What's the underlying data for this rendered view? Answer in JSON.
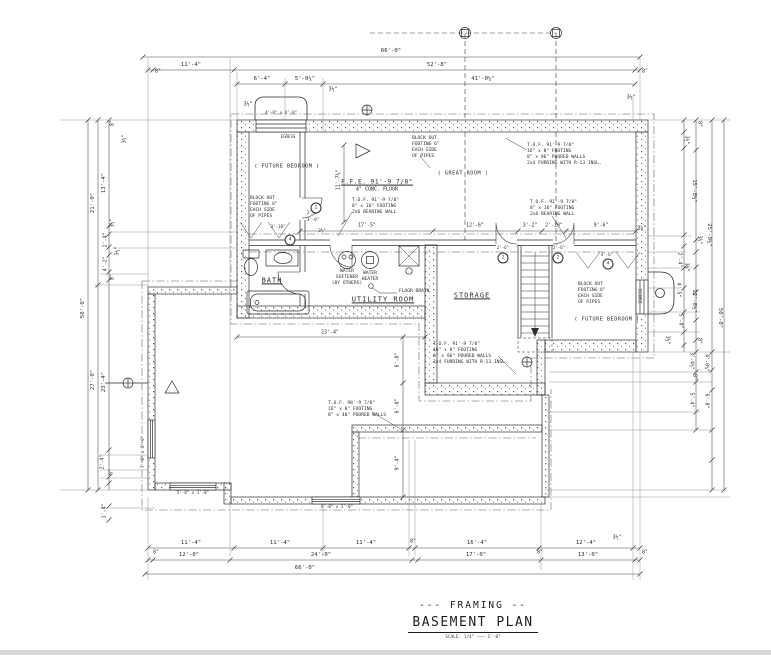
{
  "drawing": {
    "title_line1": "--- FRAMING --",
    "title_line2": "BASEMENT PLAN",
    "scale_note": "SCALE: 1/4\"  ———  1'-0\""
  },
  "labels": [
    {
      "t": "66'-0\"",
      "x": 391,
      "y": 52
    },
    {
      "t": "11'-4\"",
      "x": 191,
      "y": 66
    },
    {
      "t": "52'-8\"",
      "x": 437,
      "y": 66
    },
    {
      "t": "8\"",
      "x": 158,
      "y": 72,
      "c": "s"
    },
    {
      "t": "8\"",
      "x": 645,
      "y": 72,
      "c": "s"
    },
    {
      "t": "6'-4\"",
      "x": 262,
      "y": 80
    },
    {
      "t": "5'-0¼\"",
      "x": 305,
      "y": 80
    },
    {
      "t": "41'-0¼\"",
      "x": 483,
      "y": 80
    },
    {
      "t": "3½\"",
      "x": 333,
      "y": 90,
      "c": "s"
    },
    {
      "t": "3½\"",
      "x": 631,
      "y": 98,
      "c": "s"
    },
    {
      "t": "3½\"",
      "x": 248,
      "y": 105,
      "c": "s"
    },
    {
      "t": "11'-4\"",
      "x": 191,
      "y": 544
    },
    {
      "t": "11'-4\"",
      "x": 280,
      "y": 544
    },
    {
      "t": "11'-4\"",
      "x": 366,
      "y": 544
    },
    {
      "t": "8\"",
      "x": 413,
      "y": 542,
      "c": "s"
    },
    {
      "t": "16'-4\"",
      "x": 477,
      "y": 544
    },
    {
      "t": "12'-4\"",
      "x": 586,
      "y": 544
    },
    {
      "t": "3½\"",
      "x": 617,
      "y": 538,
      "c": "s"
    },
    {
      "t": "8\"",
      "x": 156,
      "y": 553,
      "c": "s"
    },
    {
      "t": "8\"",
      "x": 645,
      "y": 553,
      "c": "s"
    },
    {
      "t": "8\"",
      "x": 540,
      "y": 553,
      "c": "s"
    },
    {
      "t": "12'-0\"",
      "x": 189,
      "y": 556
    },
    {
      "t": "24'-0\"",
      "x": 321,
      "y": 556
    },
    {
      "t": "17'-0\"",
      "x": 476,
      "y": 556
    },
    {
      "t": "13'-0\"",
      "x": 588,
      "y": 556
    },
    {
      "t": "66'-0\"",
      "x": 305,
      "y": 569
    },
    {
      "t": "50'-0\"",
      "x": 84,
      "y": 308,
      "r": -90
    },
    {
      "t": "21'-0\"",
      "x": 94,
      "y": 203,
      "r": -90
    },
    {
      "t": "27'-0\"",
      "x": 94,
      "y": 380,
      "r": -90
    },
    {
      "t": "13'-4\"",
      "x": 105,
      "y": 183,
      "r": -90
    },
    {
      "t": "23'-4\"",
      "x": 105,
      "y": 382,
      "r": -90
    },
    {
      "t": "8\"",
      "x": 113,
      "y": 123,
      "r": -90,
      "c": "s"
    },
    {
      "t": "3½\"",
      "x": 125,
      "y": 139,
      "r": -90,
      "c": "s"
    },
    {
      "t": "3½\"",
      "x": 113,
      "y": 223,
      "r": -90,
      "c": "s"
    },
    {
      "t": "2'-4\"",
      "x": 106,
      "y": 240,
      "r": -90,
      "c": "s"
    },
    {
      "t": "3½\"",
      "x": 118,
      "y": 251,
      "r": -90,
      "c": "s"
    },
    {
      "t": "4'-2\"",
      "x": 106,
      "y": 264,
      "r": -90,
      "c": "s"
    },
    {
      "t": "8\"",
      "x": 113,
      "y": 277,
      "r": -90,
      "c": "s"
    },
    {
      "t": "2'-4\"",
      "x": 103,
      "y": 462,
      "r": -90,
      "c": "s"
    },
    {
      "t": "8\"",
      "x": 112,
      "y": 472,
      "r": -90,
      "c": "s"
    },
    {
      "t": "1'-4\"",
      "x": 105,
      "y": 511,
      "r": -90,
      "c": "s"
    },
    {
      "t": "50'-0\"",
      "x": 719,
      "y": 318,
      "r": 90
    },
    {
      "t": "25'-0½\"",
      "x": 708,
      "y": 235,
      "r": 90
    },
    {
      "t": "15'-8½\"",
      "x": 693,
      "y": 191,
      "r": 90
    },
    {
      "t": "12'-8½\"",
      "x": 693,
      "y": 301,
      "r": 90
    },
    {
      "t": "8\"",
      "x": 699,
      "y": 124,
      "r": 90,
      "c": "s"
    },
    {
      "t": "3½\"",
      "x": 686,
      "y": 140,
      "r": 90,
      "c": "s"
    },
    {
      "t": "3½\"",
      "x": 699,
      "y": 240,
      "r": 90,
      "c": "s"
    },
    {
      "t": "2'-4\"",
      "x": 679,
      "y": 260,
      "r": 90,
      "c": "s"
    },
    {
      "t": "3½\"",
      "x": 686,
      "y": 267,
      "r": 90,
      "c": "s"
    },
    {
      "t": "4'-5\"",
      "x": 678,
      "y": 290,
      "r": 90,
      "c": "s"
    },
    {
      "t": "5'-0\"",
      "x": 680,
      "y": 321,
      "r": 90,
      "c": "s"
    },
    {
      "t": "3½\"",
      "x": 667,
      "y": 340,
      "r": 90,
      "c": "s"
    },
    {
      "t": "8\"",
      "x": 699,
      "y": 341,
      "r": 90,
      "c": "s"
    },
    {
      "t": "3'-4½\"",
      "x": 691,
      "y": 361,
      "r": 90,
      "c": "s"
    },
    {
      "t": "4'-0¼\"",
      "x": 706,
      "y": 363,
      "r": 90,
      "c": "s"
    },
    {
      "t": "8\"",
      "x": 694,
      "y": 377,
      "r": 90,
      "c": "s"
    },
    {
      "t": "5'-4\"",
      "x": 691,
      "y": 400,
      "r": 90,
      "c": "s"
    },
    {
      "t": "6'-0\"",
      "x": 706,
      "y": 401,
      "r": 90,
      "c": "s"
    },
    {
      "t": "17'-5\"",
      "x": 367,
      "y": 226,
      "c": "s"
    },
    {
      "t": "12'-6\"",
      "x": 475,
      "y": 226,
      "c": "s"
    },
    {
      "t": "3'-2\"",
      "x": 530,
      "y": 226,
      "c": "s"
    },
    {
      "t": "2'-10\"",
      "x": 554,
      "y": 226,
      "c": "s"
    },
    {
      "t": "9'-6\"",
      "x": 601,
      "y": 226,
      "c": "s"
    },
    {
      "t": "3½\"",
      "x": 642,
      "y": 229,
      "c": "s"
    },
    {
      "t": "11'-7¾\"",
      "x": 339,
      "y": 180,
      "r": -90,
      "c": "s"
    },
    {
      "t": "23'-4\"",
      "x": 330,
      "y": 333,
      "c": "s"
    },
    {
      "t": "6'-0\"",
      "x": 398,
      "y": 360,
      "r": -90,
      "c": "s"
    },
    {
      "t": "6'-0\"",
      "x": 398,
      "y": 406,
      "r": -90,
      "c": "s"
    },
    {
      "t": "9'-4\"",
      "x": 398,
      "y": 463,
      "r": -90,
      "c": "s"
    },
    {
      "t": "3'-10\"",
      "x": 278,
      "y": 227,
      "c": "xs"
    },
    {
      "t": "2'-6\"",
      "x": 313,
      "y": 213,
      "c": "xs"
    },
    {
      "t": "3'-0\"",
      "x": 313,
      "y": 220,
      "c": "xs"
    },
    {
      "t": "3½\"",
      "x": 322,
      "y": 231,
      "c": "xs"
    },
    {
      "t": "2'-6\"",
      "x": 503,
      "y": 248,
      "c": "xs"
    },
    {
      "t": "2'-6\"",
      "x": 559,
      "y": 248,
      "c": "xs"
    },
    {
      "t": "4'-6\"",
      "x": 607,
      "y": 255,
      "c": "xs"
    },
    {
      "t": "4'-0\" x 4'-0\"",
      "x": 281,
      "y": 113,
      "c": "xs"
    },
    {
      "t": "EGRESS",
      "x": 288,
      "y": 137,
      "c": "xs"
    },
    {
      "t": "EGRESS",
      "x": 641,
      "y": 296,
      "r": -90,
      "c": "xs"
    },
    {
      "t": "5'-0\" x 1'-0\"",
      "x": 193,
      "y": 493,
      "c": "xs"
    },
    {
      "t": "6'-0\" x 1'-0\"",
      "x": 337,
      "y": 507,
      "c": "xs"
    },
    {
      "t": "7'-6\" x 1'-0\"",
      "x": 143,
      "y": 452,
      "r": -90,
      "c": "xs"
    }
  ],
  "notes": [
    {
      "n": "room-future-bedroom-1",
      "c": "room-p ctr",
      "x": 287,
      "y": 167,
      "lines": [
        "( FUTURE BEDROOM )"
      ]
    },
    {
      "n": "room-great-room",
      "c": "room-p ctr",
      "x": 463,
      "y": 174,
      "lines": [
        "( GREAT ROOM )"
      ]
    },
    {
      "n": "room-future-bedroom-2",
      "c": "room-p ctr",
      "x": 607,
      "y": 320,
      "lines": [
        "( FUTURE BEDROOM )"
      ]
    },
    {
      "n": "room-bath",
      "c": "room ctr u",
      "x": 272,
      "y": 281,
      "lines": [
        "BATH"
      ]
    },
    {
      "n": "room-utility",
      "c": "room ctr u",
      "x": 383,
      "y": 300,
      "lines": [
        "UTILITY ROOM"
      ]
    },
    {
      "n": "room-storage",
      "c": "room ctr u",
      "x": 472,
      "y": 296,
      "lines": [
        "STORAGE"
      ]
    },
    {
      "n": "note-ffe",
      "c": "ffe ctr",
      "x": 377,
      "y": 186,
      "lines": [
        "F.F.E. 91'-9 7/8\"",
        "4\" CONC. FLOOR"
      ]
    },
    {
      "n": "note-tof-poured-1",
      "x": 527,
      "y": 143,
      "lines": [
        "T.O.F. 91'-9 7/8\"",
        "16\" x 8\" FOOTING",
        "8\" x 96\" POURED WALLS",
        "2x4 FURRING WITH R-13 INSL."
      ]
    },
    {
      "n": "note-tof-bearing-1",
      "x": 352,
      "y": 198,
      "lines": [
        "T.O.F. 91'-9 7/8\"",
        "8\" x 16\" FOOTING",
        "2x6 BEARING WALL"
      ]
    },
    {
      "n": "note-tof-bearing-2",
      "x": 530,
      "y": 200,
      "lines": [
        "T.O.F. 91'-9 7/8\"",
        "8\" x 16\" FOOTING",
        "2x6 BEARING WALL"
      ]
    },
    {
      "n": "note-tof-poured-2",
      "x": 433,
      "y": 342,
      "lines": [
        "T.O.F. 91'-9 7/8\"",
        "16\" x 8\" FOOTING",
        "8\" x 96\" POURED WALLS",
        "2x4 FURRING WITH R-13 INSL."
      ]
    },
    {
      "n": "note-tof-frost",
      "x": 328,
      "y": 401,
      "lines": [
        "T.O.F. 98'-9 7/8\"",
        "16\" x 8\" FOOTING",
        "8\" x 48\" POURED WALLS"
      ]
    },
    {
      "n": "note-blockout-1",
      "x": 412,
      "y": 136,
      "lines": [
        "BLOCK OUT",
        "FOOTING 6\"",
        "EACH SIDE",
        "OF PIPES"
      ]
    },
    {
      "n": "note-blockout-2",
      "x": 250,
      "y": 196,
      "lines": [
        "BLOCK OUT",
        "FOOTING 6\"",
        "EACH SIDE",
        "OF PIPES"
      ]
    },
    {
      "n": "note-blockout-3",
      "x": 578,
      "y": 282,
      "lines": [
        "BLOCK OUT",
        "FOOTING 6\"",
        "EACH SIDE",
        "OF PIPES"
      ]
    },
    {
      "n": "label-water-softener",
      "c": "ctr",
      "x": 347,
      "y": 278,
      "lines": [
        "WATER",
        "SOFTENER",
        "(BY OTHERS)"
      ]
    },
    {
      "n": "label-water-heater",
      "c": "ctr",
      "x": 370,
      "y": 277,
      "lines": [
        "WATER",
        "HEATER"
      ]
    },
    {
      "n": "label-floor-drain",
      "x": 399,
      "y": 289,
      "lines": [
        "FLOOR DRAIN"
      ]
    }
  ],
  "door_tags": [
    {
      "t": "2",
      "x": 316,
      "y": 208
    },
    {
      "t": "2",
      "x": 503,
      "y": 258
    },
    {
      "t": "2",
      "x": 558,
      "y": 258
    },
    {
      "t": "4",
      "x": 290,
      "y": 240
    },
    {
      "t": "4",
      "x": 608,
      "y": 264
    }
  ]
}
